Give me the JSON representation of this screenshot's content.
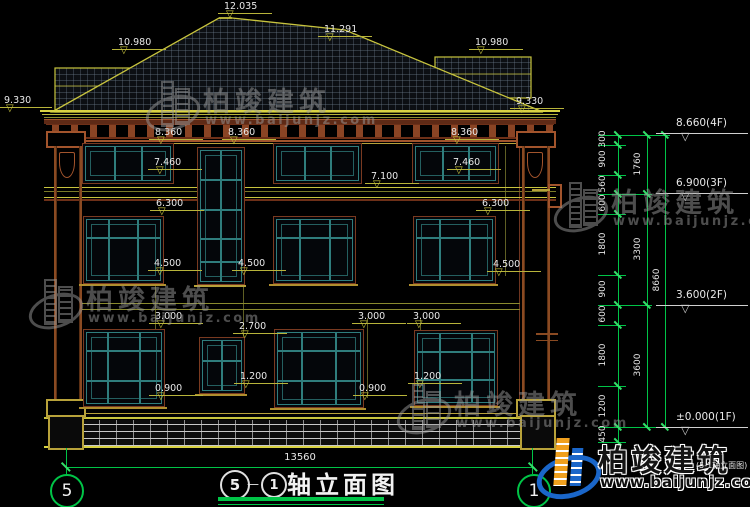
{
  "drawing": {
    "title": "轴立面图",
    "axis_left": "5",
    "axis_right": "1",
    "axis_separator": "—",
    "overall_width_dim": "13560"
  },
  "facade_dims": [
    {
      "label": "12.035",
      "x": 224,
      "y": 1
    },
    {
      "label": "10.980",
      "x": 118,
      "y": 37
    },
    {
      "label": "11.291",
      "x": 324,
      "y": 24
    },
    {
      "label": "10.980",
      "x": 475,
      "y": 37
    },
    {
      "label": "9.330",
      "x": 4,
      "y": 95
    },
    {
      "label": "9.330",
      "x": 516,
      "y": 96
    },
    {
      "label": "8.360",
      "x": 155,
      "y": 127
    },
    {
      "label": "8.360",
      "x": 228,
      "y": 127
    },
    {
      "label": "8.360",
      "x": 451,
      "y": 127
    },
    {
      "label": "7.460",
      "x": 154,
      "y": 157
    },
    {
      "label": "7.460",
      "x": 453,
      "y": 157
    },
    {
      "label": "7.100",
      "x": 371,
      "y": 171
    },
    {
      "label": "6.300",
      "x": 156,
      "y": 198
    },
    {
      "label": "6.300",
      "x": 482,
      "y": 198
    },
    {
      "label": "4.500",
      "x": 154,
      "y": 258
    },
    {
      "label": "4.500",
      "x": 238,
      "y": 258
    },
    {
      "label": "4.500",
      "x": 493,
      "y": 259
    },
    {
      "label": "3.000",
      "x": 155,
      "y": 311
    },
    {
      "label": "3.000",
      "x": 358,
      "y": 311
    },
    {
      "label": "3.000",
      "x": 413,
      "y": 311
    },
    {
      "label": "2.700",
      "x": 239,
      "y": 321
    },
    {
      "label": "1.200",
      "x": 240,
      "y": 371
    },
    {
      "label": "1.200",
      "x": 414,
      "y": 371
    },
    {
      "label": "0.900",
      "x": 155,
      "y": 383
    },
    {
      "label": "0.900",
      "x": 359,
      "y": 383
    }
  ],
  "levels": [
    {
      "label": "8.660(4F)",
      "y": 133
    },
    {
      "label": "6.900(3F)",
      "y": 193
    },
    {
      "label": "3.600(2F)",
      "y": 305
    },
    {
      "label": "±0.000(1F)",
      "y": 427
    }
  ],
  "chain": {
    "col1": [
      {
        "label": "300",
        "y1": 135,
        "y2": 145
      },
      {
        "label": "900",
        "y1": 145,
        "y2": 175
      },
      {
        "label": "560",
        "y1": 175,
        "y2": 194
      },
      {
        "label": "600",
        "y1": 194,
        "y2": 214
      },
      {
        "label": "1800",
        "y1": 214,
        "y2": 275
      },
      {
        "label": "900",
        "y1": 275,
        "y2": 305
      },
      {
        "label": "600",
        "y1": 305,
        "y2": 325
      },
      {
        "label": "1800",
        "y1": 325,
        "y2": 386
      },
      {
        "label": "1200",
        "y1": 386,
        "y2": 427
      },
      {
        "label": "450",
        "y1": 427,
        "y2": 442
      }
    ],
    "col2": [
      {
        "label": "1760",
        "y1": 135,
        "y2": 194
      },
      {
        "label": "3300",
        "y1": 194,
        "y2": 305
      },
      {
        "label": "3600",
        "y1": 305,
        "y2": 427
      }
    ],
    "col3": [
      {
        "label": "8660",
        "y1": 135,
        "y2": 427
      }
    ]
  },
  "watermarks": [
    {
      "brand": "柏竣建筑",
      "url": "www.baijunjz.com",
      "x": 145,
      "y": 80
    },
    {
      "brand": "柏竣建筑",
      "url": "www.baijunjz.com",
      "x": 553,
      "y": 181
    },
    {
      "brand": "柏竣建筑",
      "url": "www.baijunjz.com",
      "x": 28,
      "y": 278
    },
    {
      "brand": "柏竣建筑",
      "url": "www.baijunjz.com",
      "x": 396,
      "y": 383
    }
  ],
  "logo": {
    "brand": "柏竣建筑",
    "url": "www.baijunjz.com",
    "overlay_text": "(5-1轴立面图)"
  },
  "colors": {
    "line_green": "#00c447",
    "line_olive": "#b8b43a",
    "line_bright_olive": "#d8d242",
    "frame_brown": "#7a3a20",
    "frame_teal": "#2f7d7d",
    "cornice_brown": "#a2542c",
    "text_white": "#e8e8e8",
    "logo_blue": "#1a66c9",
    "logo_orange": "#f0a01e",
    "watermark_gray": "#9a9a9a"
  }
}
